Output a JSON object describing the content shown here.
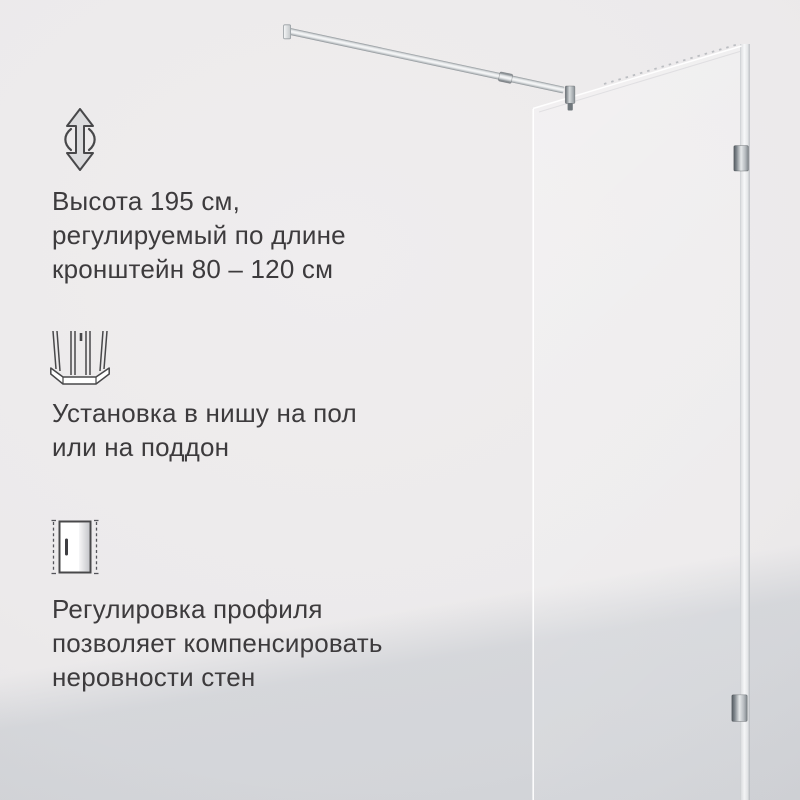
{
  "features": [
    {
      "icon": "height-adjustable-icon",
      "lines": [
        "Высота 195 см,",
        "регулируемый по длине",
        "кронштейн 80 – 120 см"
      ]
    },
    {
      "icon": "niche-floor-tray-installation-icon",
      "lines": [
        "Установка в нишу на пол",
        "или на поддон"
      ]
    },
    {
      "icon": "profile-adjustment-icon",
      "lines": [
        "Регулировка профиля",
        "позволяет компенсировать",
        "неровности стен"
      ]
    }
  ],
  "colors": {
    "background_light": "#ECEAEB",
    "background_shade": "#D5D6D9",
    "text": "#3D3B3D",
    "icon_stroke": "#48484A",
    "chrome": "#9AA0A4",
    "glass_edge": "#FFFFFF"
  }
}
